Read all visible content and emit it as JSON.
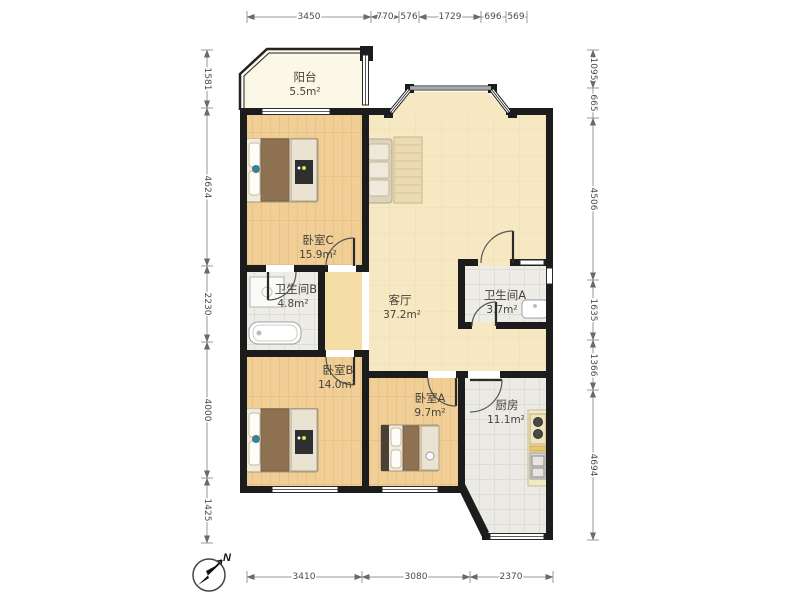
{
  "rooms": [
    {
      "id": "balcony",
      "name": "阳台",
      "area": "5.5m²"
    },
    {
      "id": "bedroom-c",
      "name": "卧室C",
      "area": "15.9m²"
    },
    {
      "id": "living-room",
      "name": "客厅",
      "area": "37.2m²"
    },
    {
      "id": "bathroom-b",
      "name": "卫生间B",
      "area": "4.8m²"
    },
    {
      "id": "bathroom-a",
      "name": "卫生间A",
      "area": "3.7m²"
    },
    {
      "id": "bedroom-b",
      "name": "卧室B",
      "area": "14.0m²"
    },
    {
      "id": "bedroom-a",
      "name": "卧室A",
      "area": "9.7m²"
    },
    {
      "id": "kitchen",
      "name": "厨房",
      "area": "11.1m²"
    }
  ],
  "dimensions": {
    "top": [
      "3450",
      "770",
      "576",
      "1729",
      "696",
      "569"
    ],
    "left": [
      "1581",
      "4624",
      "2230",
      "4000",
      "1425"
    ],
    "right": [
      "1095",
      "665",
      "4506",
      "1635",
      "1366",
      "4694"
    ],
    "bottom": [
      "3410",
      "3080",
      "2370"
    ]
  },
  "compass": {
    "label": "N"
  },
  "colors": {
    "wall": "#1c1c1c",
    "wood_floor": "#F0CE96",
    "living_floor": "#F6E8C2",
    "tile_floor": "#EDECE7",
    "balcony_floor": "#FBF8E8"
  }
}
